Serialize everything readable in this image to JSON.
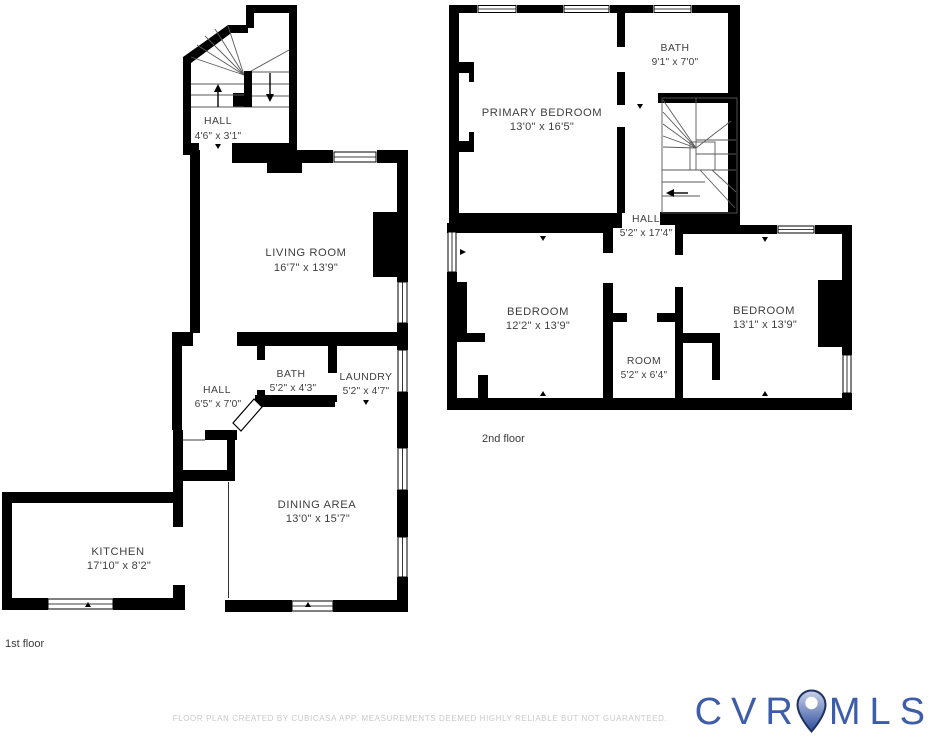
{
  "document": {
    "type": "floor-plan",
    "footer_disclaimer": "FLOOR PLAN CREATED BY CUBICASA APP. MEASUREMENTS DEEMED HIGHLY RELIABLE BUT NOT GUARANTEED."
  },
  "floors": {
    "first": {
      "caption": "1st floor",
      "rooms": {
        "stair_hall": {
          "name": "HALL",
          "dims": "4'6\" x 3'1\""
        },
        "living": {
          "name": "LIVING ROOM",
          "dims": "16'7\" x 13'9\""
        },
        "hall": {
          "name": "HALL",
          "dims": "6'5\" x 7'0\""
        },
        "bath": {
          "name": "BATH",
          "dims": "5'2\" x 4'3\""
        },
        "laundry": {
          "name": "LAUNDRY",
          "dims": "5'2\" x 4'7\""
        },
        "dining": {
          "name": "DINING AREA",
          "dims": "13'0\" x 15'7\""
        },
        "kitchen": {
          "name": "KITCHEN",
          "dims": "17'10\" x 8'2\""
        }
      }
    },
    "second": {
      "caption": "2nd floor",
      "rooms": {
        "bath": {
          "name": "BATH",
          "dims": "9'1\" x 7'0\""
        },
        "primary": {
          "name": "PRIMARY BEDROOM",
          "dims": "13'0\" x 16'5\""
        },
        "hall": {
          "name": "HALL",
          "dims": "5'2\" x 17'4\""
        },
        "bedroom_left": {
          "name": "BEDROOM",
          "dims": "12'2\" x 13'9\""
        },
        "bedroom_right": {
          "name": "BEDROOM",
          "dims": "13'1\" x 13'9\""
        },
        "room": {
          "name": "ROOM",
          "dims": "5'2\" x 6'4\""
        }
      }
    }
  },
  "logo": {
    "text_left": "CVR",
    "text_right": "MLS",
    "pin_icon": "location-pin",
    "colors": {
      "letters": "#3d5ca9",
      "pin_outline": "#1d3161",
      "pin_fill_top": "#c9d2e8",
      "pin_fill_bottom": "#2e4f9e"
    }
  },
  "colors": {
    "walls": "#000000",
    "room_text": "#3f3f3f",
    "footer_text": "#c9c9c9",
    "background": "#ffffff"
  }
}
